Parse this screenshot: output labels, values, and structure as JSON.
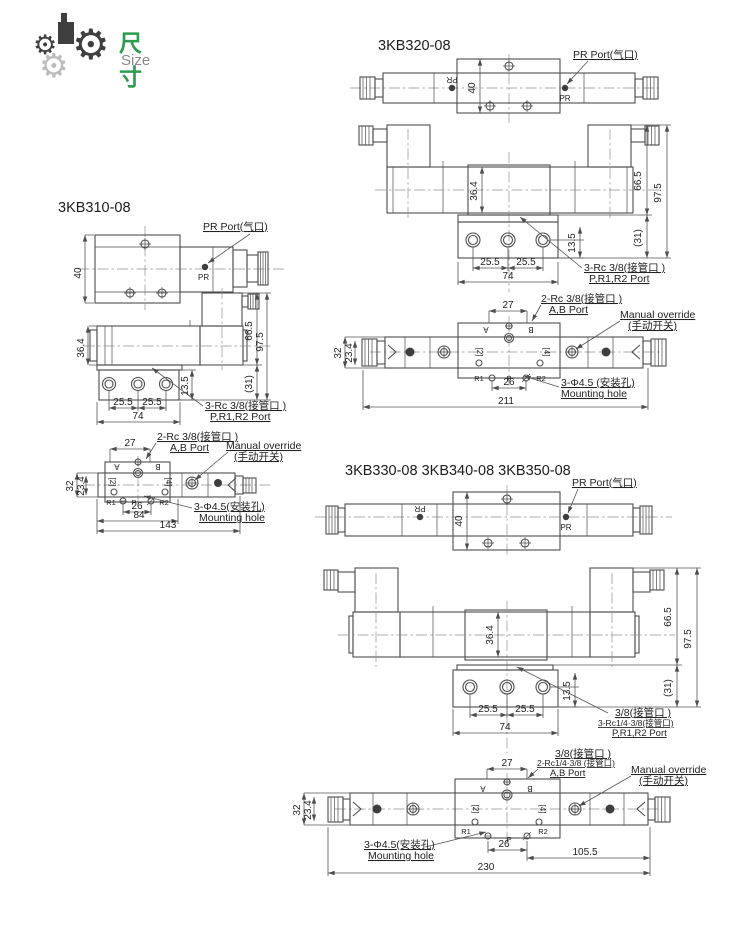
{
  "header": {
    "title_cn": "尺寸",
    "title_en": "Size",
    "accent_green": "#2e9b4e",
    "gear_dark": "#3f3f3f",
    "gear_light": "#bcbcbc",
    "gear_icon": "gear"
  },
  "s310": {
    "title": "3KB310-08",
    "pr_port": "PR Port(气口)",
    "pr": "PR",
    "d40": "40",
    "d364": "36.4",
    "d665": "66.5",
    "d975": "97.5",
    "d31": "(31)",
    "d135": "13.5",
    "d255": "25.5",
    "d74": "74",
    "port_l1": "3-Rc 3/8(接管口 )",
    "port_l2": "P,R1,R2 Port",
    "d27": "27",
    "ab_l1": "2-Rc 3/8(接管口 )",
    "ab_l2": "A,B Port",
    "manual_l1": "Manual override",
    "manual_l2": "(手动开关)",
    "d32": "32",
    "d234": "23.4",
    "d26": "26",
    "d84": "84",
    "d143": "143",
    "mount_l1": "3-Φ4.5(安装孔)",
    "mount_l2": "Mounting hole",
    "a": "A",
    "b": "B",
    "r1": "R1",
    "p": "P",
    "r2": "R2",
    "n2": "[2]",
    "n4": "[4]"
  },
  "s320": {
    "title": "3KB320-08",
    "pr_port": "PR Port(气口)",
    "pr": "PR",
    "d40": "40",
    "d364": "36.4",
    "d665": "66.5",
    "d975": "97.5",
    "d31": "(31)",
    "d135": "13.5",
    "d255": "25.5",
    "d74": "74",
    "port_l1": "3-Rc 3/8(接管口 )",
    "port_l2": "P,R1,R2 Port",
    "d27": "27",
    "ab_l1": "2-Rc 3/8(接管口 )",
    "ab_l2": "A,B Port",
    "manual_l1": "Manual override",
    "manual_l2": "(手动开关)",
    "d32": "32",
    "d234": "23.4",
    "d26": "26",
    "d211": "211",
    "mount_l1": "3-Φ4.5 (安装孔)",
    "mount_l2": "Mounting hole",
    "a": "A",
    "b": "B",
    "r1": "R1",
    "p": "P",
    "r2": "R2",
    "n2": "[2]",
    "n4": "[4]"
  },
  "s330": {
    "title": "3KB330-08  3KB340-08  3KB350-08",
    "pr_port": "PR Port(气口)",
    "pr": "PR",
    "d40": "40",
    "d364": "36.4",
    "d665": "66.5",
    "d975": "97.5",
    "d31": "(31)",
    "d135": "13.5",
    "d255": "25.5",
    "d74": "74",
    "port_l0": "3/8(接管口 )",
    "port_l1": "3-Rc1/4·3/8(接管口)",
    "port_l2": "P,R1,R2 Port",
    "d27": "27",
    "ab_l0": "3/8(接管口 )",
    "ab_l1": "2-Rc1/4·3/8 (接管口)",
    "ab_l2": "A,B Port",
    "manual_l1": "Manual override",
    "manual_l2": "(手动开关)",
    "d32": "32",
    "d234": "23.4",
    "d26": "26",
    "d1055": "105.5",
    "d230": "230",
    "mount_l1": "3-Φ4.5(安装孔)",
    "mount_l2": "Mounting hole",
    "a": "A",
    "b": "B",
    "r1": "R1",
    "p": "P",
    "r2": "R2",
    "n2": "[2]",
    "n4": "[4]"
  }
}
